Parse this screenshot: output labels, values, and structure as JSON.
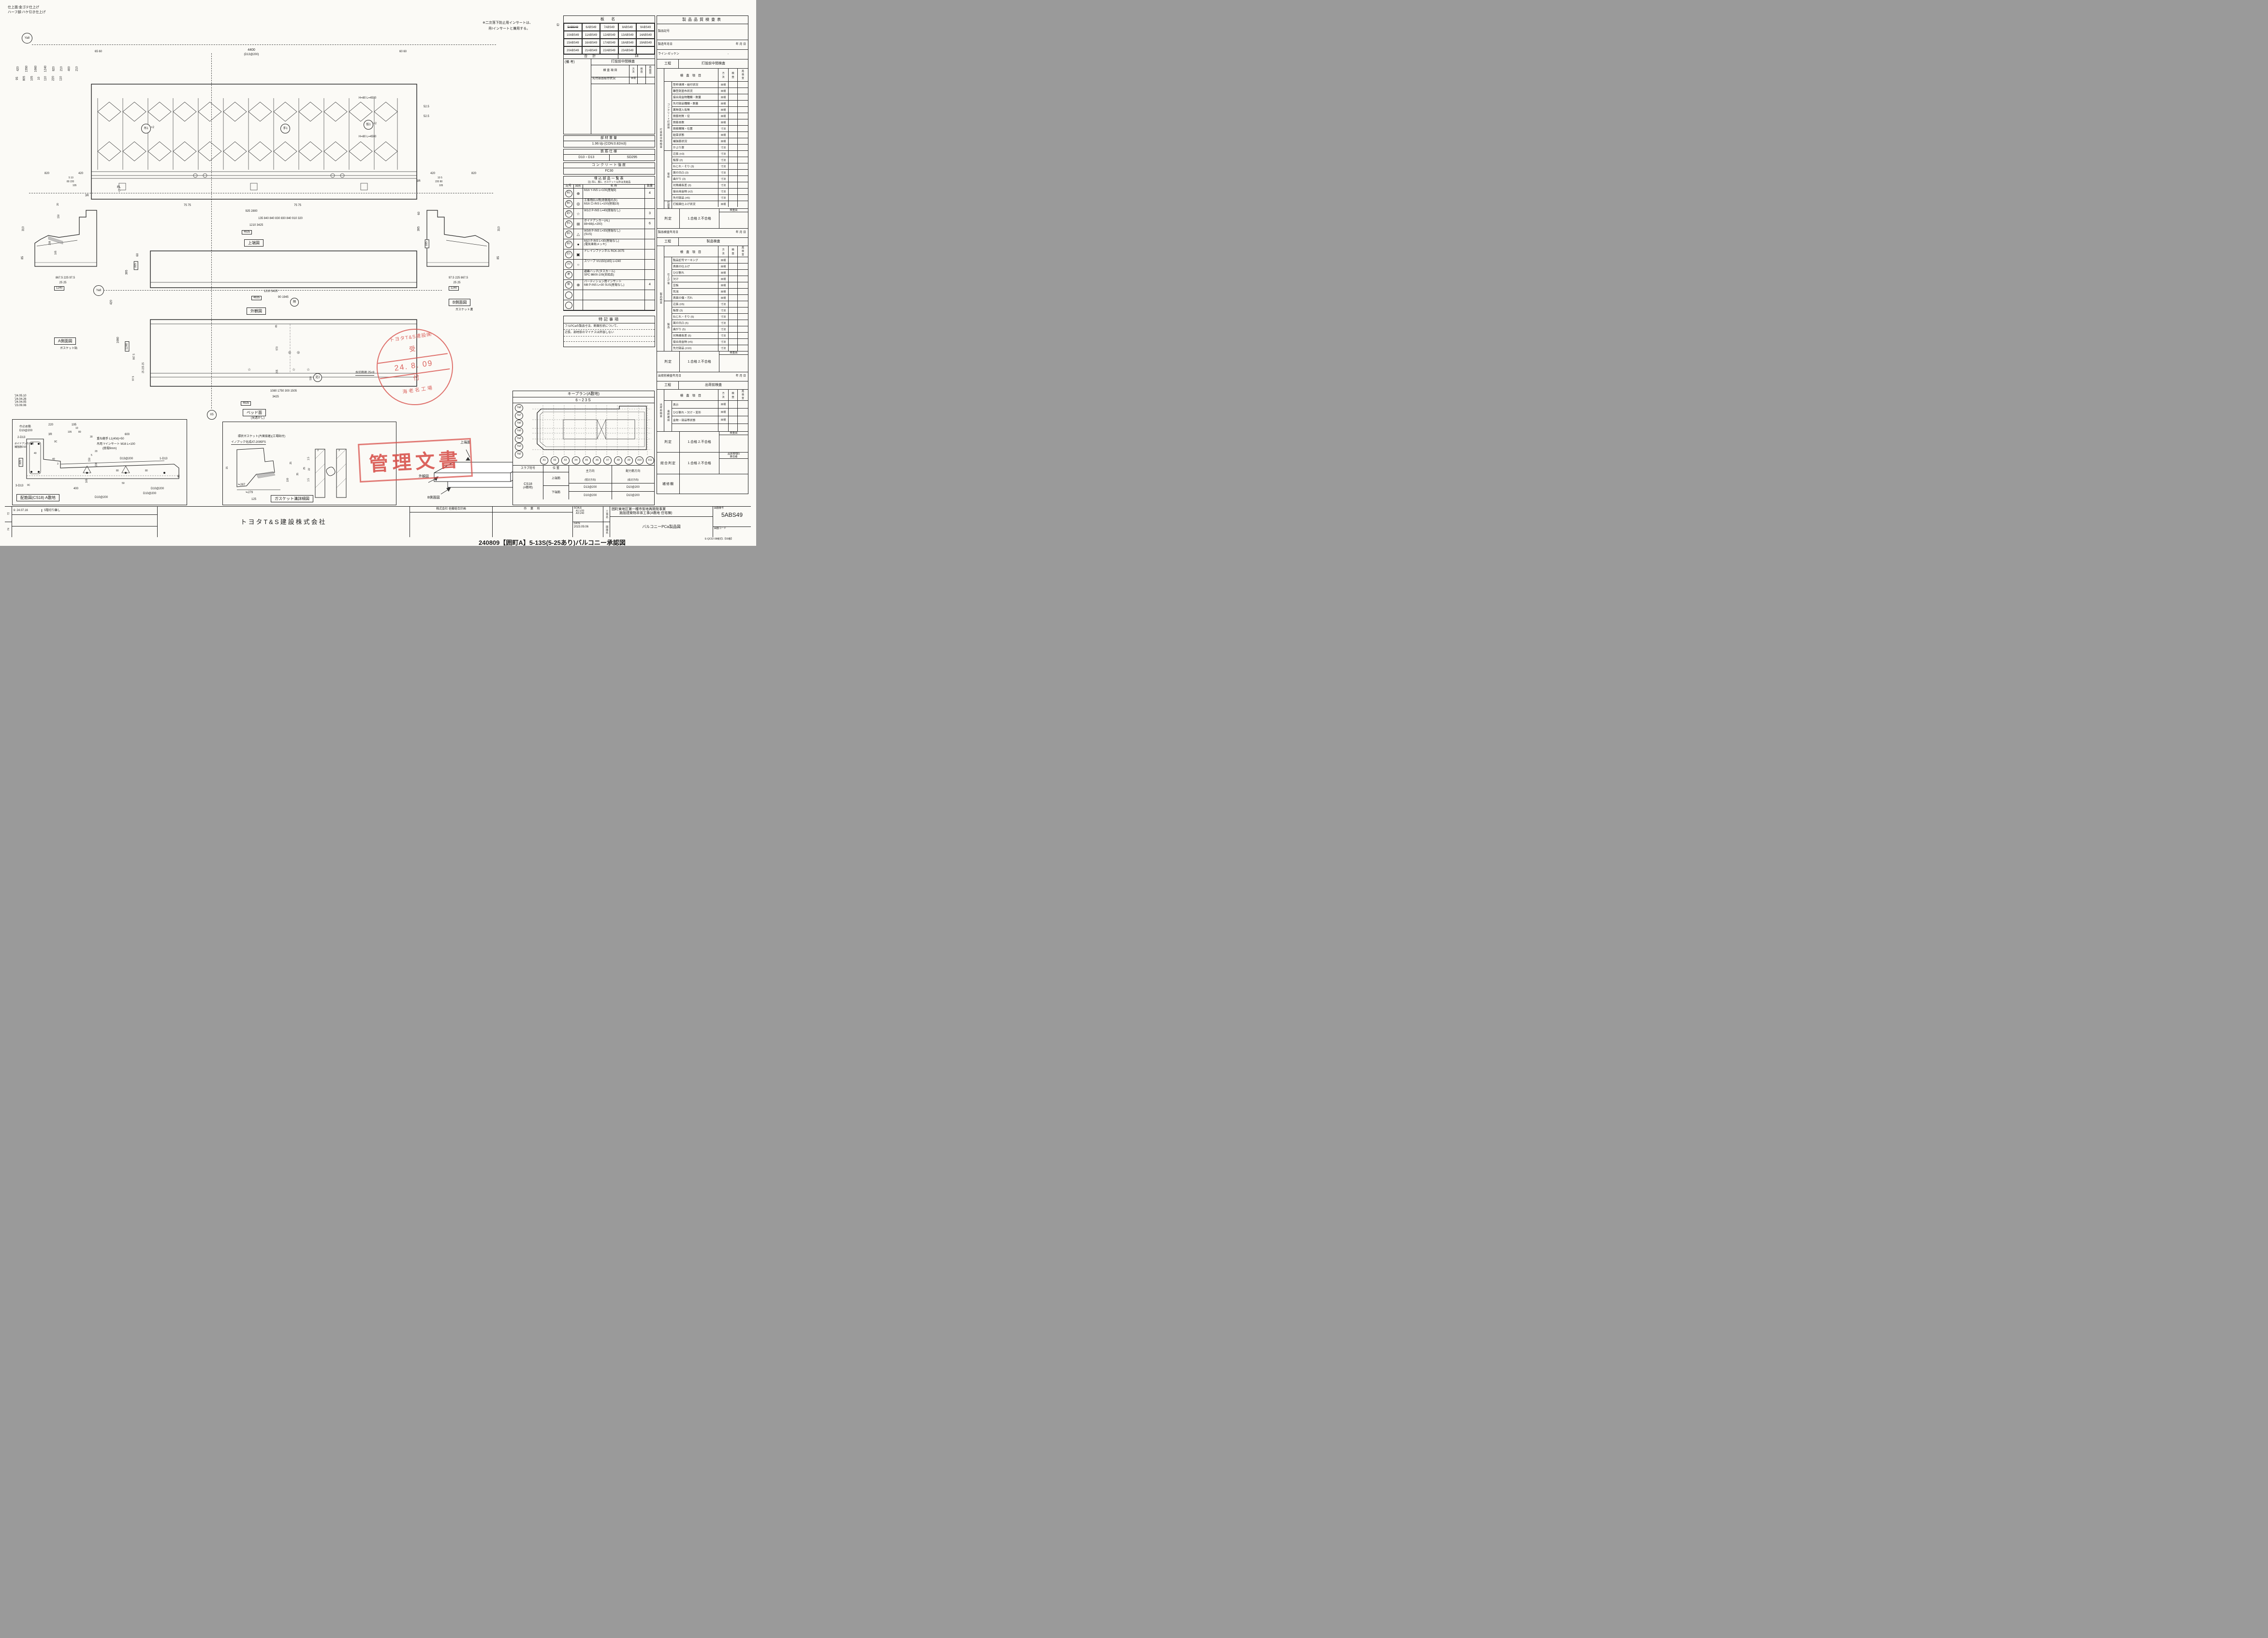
{
  "icons": {
    "star": "☆",
    "target": "⊕",
    "double_circle": "◎",
    "square_cross": "⊞",
    "triangle": "△",
    "dot": "●",
    "drain": "▣",
    "sleeve": "○",
    "cross_circle": "⊗",
    "fl_mark": "▽",
    "rev_circle": "①"
  },
  "notes": {
    "finish1": "仕上面:金ゴテ仕上げ",
    "finish2": "ハーフ部:ハケ引き仕上げ",
    "insert1": "※二次落下防止用インサートは、",
    "insert2": "吊Ⅰインサートと兼用する。"
  },
  "plate": {
    "title": "板 名",
    "struck": "5ABS49",
    "cells": [
      "6ABS49",
      "7ABS49",
      "8ABS49",
      "9ABS49",
      "10ABS49",
      "11ABS49",
      "12ABS49",
      "13ABS49",
      "14ABS49",
      "15ABS49",
      "16ABS49",
      "17ABS49",
      "18ABS49",
      "19ABS49",
      "20ABS49",
      "21ABS49",
      "22ABS49",
      "23ABS49",
      ""
    ],
    "total_label": "合 計",
    "total": "18"
  },
  "mini": {
    "biko": "(備 考)",
    "title": "打設前中間検査",
    "item": "検 査 項 目",
    "method": "方\n法",
    "check": "検\n査",
    "recheck": "再\n検\n査",
    "row_item": "先付部品取付状況",
    "row_method": "目視"
  },
  "weight": {
    "title": "部材重量",
    "value": "1.96  t/p (CON:0.82m3)"
  },
  "rebar": {
    "title": "鉄筋仕様",
    "size": "D10・D13",
    "grade": "SD295"
  },
  "concrete": {
    "title": "コンクリート強度",
    "value": "FC30"
  },
  "embed": {
    "title": "埋込部品一覧表",
    "note": "注) 吊1、脱1、ガスケット以外は支給品",
    "h_sym": "記号",
    "h_fig": "図形",
    "h_name": "名  称",
    "h_qty": "数量",
    "rows": [
      {
        "sym": "吊1",
        "glyph": "⊕",
        "n1": "M16 Y-INS L=100(座堀9)",
        "n2": "",
        "qty": "4"
      },
      {
        "sym": "仮1",
        "glyph": "◎",
        "n1": "工事用ELV用(奇数階のみ)",
        "n2": "M16 ロ-INS L=100(座堀19)",
        "qty": ""
      },
      {
        "sym": "足2",
        "glyph": "☆",
        "n1": "W1/2 P-INS L=40(座堀なし)",
        "n2": "",
        "qty": "3"
      },
      {
        "sym": "手1",
        "glyph": "⊞",
        "n1": "ボイドアンカー(AL)",
        "n2": "88×88(L=200)",
        "qty": "6"
      },
      {
        "sym": "本1",
        "glyph": "△",
        "n1": "W3/8 P-INS L=30(座堀なし)",
        "n2": "(SUS)",
        "qty": ""
      },
      {
        "sym": "本2",
        "glyph": "●",
        "n1": "M10 P-INS L=30(座堀なし)",
        "n2": "(電気亜鉛メッキ)",
        "qty": ""
      },
      {
        "sym": "打1",
        "glyph": "▣",
        "n1": "ドレインファンネル RCK-3075",
        "n2": "",
        "qty": ""
      },
      {
        "sym": "ス2",
        "glyph": "○",
        "n1": "スリーブ VU150(165) L=240",
        "n2": "",
        "qty": ""
      },
      {
        "sym": "避",
        "glyph": "",
        "n1": "避難ハッチ(タスカール)",
        "n2": "SPC Ⅲ600-109(支給品)",
        "qty": ""
      },
      {
        "sym": "隔",
        "glyph": "⊗",
        "n1": "パーティション用インサート",
        "n2": "M8 P-INS L=30 SUS(座堀なし)",
        "qty": "4"
      },
      {
        "sym": "",
        "glyph": "",
        "n1": "",
        "n2": "",
        "qty": ""
      },
      {
        "sym": "",
        "glyph": "",
        "n1": "",
        "n2": "",
        "qty": ""
      }
    ]
  },
  "special": {
    "title": "特記事項",
    "line1": "フルPCaの製品寸法、断面形状について、",
    "line2": "辺長、部材厚のマイナスは許容しない"
  },
  "keyplan": {
    "title": "キープラン(A敷地)",
    "range": "6~23S",
    "ya": [
      "Ya8",
      "Ya7",
      "Ya6",
      "Ya5",
      "Ya4",
      "Ya3",
      "Ya2"
    ],
    "x": [
      "X1",
      "X2",
      "X3",
      "X4",
      "X5",
      "X6",
      "X7",
      "X8",
      "X9",
      "X10",
      "X11"
    ],
    "slab": {
      "h1": "スラブ符号",
      "h2": "位 置",
      "h3": "主方向",
      "h3b": "(短辺方向)",
      "h4": "配力筋方向",
      "h4b": "(長辺方向)",
      "code": "CS18",
      "code2": "(A敷地)",
      "r1": "上端筋",
      "r1a": "D13@200",
      "r1b": "D10@200",
      "r2": "下端筋",
      "r2a": "D10@200",
      "r2b": "D10@200"
    }
  },
  "quality": {
    "title": "製品品質検査表",
    "product_code_label": "製品記号",
    "mfg_date_label": "製造年月日",
    "ymd": "年        月        日",
    "line_label": "ライン-ゼッケン",
    "line_value": "-",
    "process_label": "工程",
    "col_item": "検 査 項 目",
    "col_method": "方\n法",
    "col_check": "検\n査",
    "col_recheck": "再\n検\n査",
    "inspector": "検査員",
    "judge_label": "判定",
    "judge_value": "1.合格   2.不合格",
    "s1": {
      "process": "打設前中間検査",
      "outer": "打設前中間検査",
      "g1": {
        "label": "コンクリート打設前",
        "rows": [
          {
            "t": "型枠清掃・組付状況",
            "m": "目視"
          },
          {
            "t": "離型剤塗布状況",
            "m": "目視"
          },
          {
            "t": "接合用金物種類・数量",
            "m": "目視"
          },
          {
            "t": "先付部品種類・数量",
            "m": "目視"
          },
          {
            "t": "異物混入有無",
            "m": "目視"
          },
          {
            "t": "鉄筋材質・径",
            "m": "目視"
          },
          {
            "t": "鉄筋本数",
            "m": "目視"
          },
          {
            "t": "鉄筋間隔・位置",
            "m": "寸法"
          },
          {
            "t": "結束状態",
            "m": "目視"
          },
          {
            "t": "補強筋状況",
            "m": "目視"
          },
          {
            "t": "かぶり厚",
            "m": "寸法"
          }
        ]
      },
      "g2": {
        "label": "型枠",
        "rows": [
          {
            "t": "辺長 (±3)",
            "m": "寸法"
          },
          {
            "t": "板厚 (2)",
            "m": "寸法"
          },
          {
            "t": "ねじれ・そり (3)",
            "m": "寸法"
          },
          {
            "t": "面の凹凸 (3)",
            "m": "寸法"
          },
          {
            "t": "曲がり (3)",
            "m": "寸法"
          },
          {
            "t": "対角線長差 (3)",
            "m": "寸法"
          },
          {
            "t": "接合用金物 (±2)",
            "m": "寸法"
          },
          {
            "t": "先付部品 (±5)",
            "m": "寸法"
          }
        ]
      },
      "after_label": "打設後",
      "after_item": "打設面仕上げ状況",
      "after_method": "目視"
    },
    "s2": {
      "date_label": "製品検査年月日",
      "process": "製品検査",
      "outer": "製品検査",
      "g1": {
        "label": "仕上げ後",
        "rows": [
          {
            "t": "製品記号マーキング",
            "m": "目視"
          },
          {
            "t": "表面の仕上げ",
            "m": "目視"
          },
          {
            "t": "ひび割れ",
            "m": "目視"
          },
          {
            "t": "欠け",
            "m": "目視"
          },
          {
            "t": "豆板",
            "m": "目視"
          },
          {
            "t": "気泡",
            "m": "目視"
          },
          {
            "t": "表面の傷・汚れ",
            "m": "目視"
          }
        ]
      },
      "g2": {
        "label": "製品",
        "rows": [
          {
            "t": "辺長 (±5)",
            "m": "寸法"
          },
          {
            "t": "板厚 (3)",
            "m": "寸法"
          },
          {
            "t": "ねじれ・そり (5)",
            "m": "寸法"
          },
          {
            "t": "面の凹凸 (5)",
            "m": "寸法"
          },
          {
            "t": "曲がり (5)",
            "m": "寸法"
          },
          {
            "t": "対角線長差 (5)",
            "m": "寸法"
          },
          {
            "t": "接合用金物 (±5)",
            "m": "寸法"
          },
          {
            "t": "先付部品 (±10)",
            "m": "寸法"
          }
        ]
      }
    },
    "s3": {
      "date_label": "出荷前検査年月日",
      "process": "出荷前検査",
      "outer": "出荷前検査",
      "group": "最終確認",
      "rows": [
        {
          "t": "表示",
          "m": "目視"
        },
        {
          "t": "ひび割れ・欠け・変形",
          "m": "目視"
        },
        {
          "t": "金物・部品等状態",
          "m": "目視"
        },
        {
          "t": "",
          "m": ""
        }
      ]
    },
    "overall_label": "総合判定",
    "overall_value": "1.合格   2.不合格",
    "qc1": "品質管理G",
    "qc2": "責任者",
    "repair_label": "補修欄"
  },
  "titleblock": {
    "company": "トヨタT&S建設株式会社",
    "architect": "株式会社 佐藤総合計画",
    "site": "作 業 所",
    "scale_label": "SCALE",
    "scale1": "A1:1/20",
    "scale2": "A3:1/40",
    "date_label": "DATE",
    "date": "2023.09.06",
    "kouji_label": "工事名",
    "project1": "囲町東地区第一種市街地再開発事業",
    "project2": "施設建築物本体工事(A敷地 住宅棟)",
    "zumen_label": "図面名",
    "drawing_name": "バルコニーPCa製品図",
    "num_label": "図面番号",
    "num": "5ABS49",
    "code_label": "図面コード",
    "form": "E-QC02-08様式1【00版】"
  },
  "footer": {
    "annotation": "240809【囲町A】5-13S(5-25あり)バルコニー承認図"
  },
  "revisions": {
    "dates": [
      "'24.05.10",
      "'24.04.26",
      "'24.04.05",
      "'23.09.06"
    ],
    "r1_no": "①",
    "r1_date": "24.07.16",
    "r1_text": "5階切り離し",
    "c1": "訂",
    "c2": "正"
  },
  "stamps": {
    "circle_top": "トヨタT&S建設㈱",
    "uke": "受",
    "tsuke": "付",
    "date": "24. 8. 09",
    "circle_bottom": "海老名工場",
    "box": "管理文書"
  },
  "views": {
    "top": {
      "caption": "上端図",
      "grid": "Ya8",
      "rebar1": "H=80 L=4500",
      "rebar2": "H=80 L=4500",
      "dtl": "65  60",
      "dspan": "4400",
      "dspan2": "(D13@200)",
      "dtr": "60  60",
      "dims_left": [
        "420",
        "1550",
        "1660",
        "1240",
        "820",
        "210",
        "400",
        "210",
        "95",
        "805",
        "105",
        "10",
        "110",
        "220",
        "110"
      ],
      "dr1": "52.5",
      "dr2": "52.5",
      "c1": "吊1",
      "c1x": "×2",
      "c2": "手1",
      "c3": "仮1",
      "c3x": "×2",
      "b0": "75  75",
      "b0b": "75  75",
      "b1": "925                                   2800",
      "b2": "135    840      840      830      830      840      910    320",
      "b3": "1210                         3425",
      "b4": "4635"
    },
    "front": {
      "caption": "外観図",
      "fl": "FL",
      "dl1": "60",
      "dl2": "335",
      "dl3": "395",
      "dr1": "60",
      "dr2": "335",
      "dr3": "395",
      "b1": "1210                         3425",
      "b2": "4635"
    },
    "aside": {
      "caption": "A側面図",
      "sub": "ガスケット貼",
      "t1": "820",
      "t2": "420",
      "t3": "5 10",
      "t4": "80  220",
      "t5": "105",
      "r3": "3R",
      "l1": "310",
      "l2": "85",
      "m1": "20",
      "m2": "150",
      "m3": "208",
      "m4": "165",
      "b1": "867.5          225      97.5",
      "b2": "25    25",
      "b3": "1240"
    },
    "bside": {
      "caption": "B側面図",
      "sub": "ガスケット溝",
      "t1": "420",
      "t2": "820",
      "t3": "10 5",
      "t4": "220  80",
      "t5": "105",
      "r3": "3R",
      "l1": "395",
      "l2": "335",
      "l3": "60",
      "r1": "310",
      "r2": "85",
      "b1": "97.5      225          867.5",
      "b2": "25    25",
      "b3": "1240"
    },
    "bed": {
      "caption": "ベッド面",
      "sub": "(見透かし)",
      "grid": "Ya8",
      "gx": "X5",
      "t1": "90          1945",
      "d420": "420",
      "l1": "1660",
      "l2": "1240",
      "l3": "867.5",
      "l4": "25 225 25",
      "l5": "97.5",
      "i1": "65",
      "i2": "970",
      "i3": "205",
      "i4": "110",
      "kaku": "隔",
      "asi": "足2",
      "mizukiri": "水切目地 25×9",
      "b1": "1080            1750          300         1505",
      "b2": "3425",
      "b3": "4635"
    },
    "haikin": {
      "caption": "配筋図(CS18) A敷地",
      "lb1": "巾止め筋",
      "lb2": "D10@200",
      "lb3": "2-D13",
      "lb4": "3R",
      "lb5": "ボイドアンカー用",
      "lb6": "補強筋D10",
      "lb7": "9C",
      "lb8": "9C",
      "lb9": "3-D13",
      "lb10": "吊用 Yインサート M16 L=100",
      "lb11": "(座堀9mm)",
      "lb12": "重ね継手 L1(40d)+50",
      "lb13": "D13@200",
      "lb14": "1-D13",
      "lb15": "D10@200",
      "lb16": "D10@200",
      "lb17": "D10@200",
      "d1": "220",
      "d2": "195",
      "d3": "10",
      "d4": "105",
      "d5": "80",
      "d6": "600",
      "d7": "30",
      "d8": "20",
      "d9": "5",
      "d10": "150",
      "d11": "208",
      "d12": "40",
      "d13": "40",
      "d14": "3",
      "d15": "335",
      "d16": "165",
      "d17": "400",
      "d18": "50",
      "d19": "80",
      "d20": "80",
      "d21": "85"
    },
    "gasket": {
      "caption": "ガスケット溝詳細図",
      "n1": "環状ガスケット(片面接着)(工場貼付)",
      "n2": "イノアック化成AT-2095FS",
      "d1": "15",
      "d2": "≒287",
      "d3": "≒279",
      "d4": "125",
      "d5": "100",
      "d6": "3",
      "d7": "3",
      "d8": "1.5",
      "d9": "25",
      "d10": "22",
      "d11": "1.5",
      "d12": "35",
      "d13": "25"
    },
    "iso": {
      "t1": "上端面",
      "t2": "A側面図",
      "t3": "外観図",
      "t4": "ベッド面(見透かし)",
      "t5": "B側面図"
    }
  }
}
